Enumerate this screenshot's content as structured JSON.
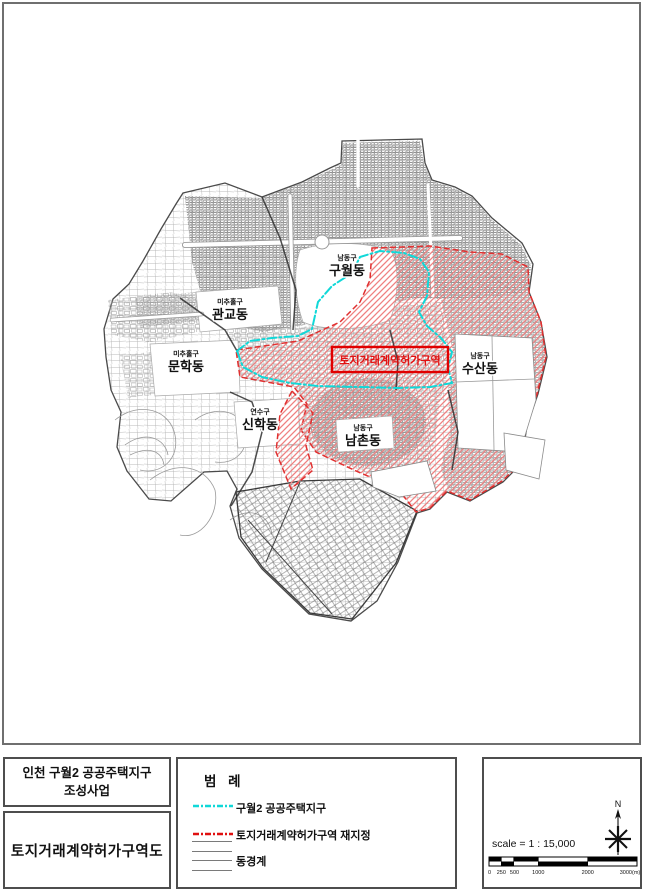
{
  "map": {
    "labels": [
      {
        "district": "남동구",
        "name": "구월동"
      },
      {
        "district": "미추홀구",
        "name": "관교동"
      },
      {
        "district": "미추홀구",
        "name": "문학동"
      },
      {
        "district": "연수구",
        "name": "신학동"
      },
      {
        "district": "남동구",
        "name": "남촌동"
      },
      {
        "district": "남동구",
        "name": "수산동"
      }
    ],
    "zone_box_label": "토지거래계약허가구역",
    "colors": {
      "permit_zone_line": "#e03030",
      "permit_zone_hatch": "#ef8080",
      "housing_district_line": "#10d8d8",
      "parcel_gray": "#8a8a8a"
    }
  },
  "title_block": {
    "project_title": "인천 구월2 공공주택지구",
    "project_subtitle": "조성사업",
    "drawing_title": "토지거래계약허가구역도"
  },
  "legend": {
    "title": "범 례",
    "items": [
      {
        "label": "구월2 공공주택지구"
      },
      {
        "label": "토지거래계약허가구역 재지정"
      },
      {
        "label": "동경계"
      }
    ]
  },
  "scale_panel": {
    "north_label": "N",
    "scale_text": "scale = 1 : 15,000",
    "ticks": [
      "0",
      "250",
      "500",
      "1000",
      "2000",
      "3000(m)"
    ]
  }
}
